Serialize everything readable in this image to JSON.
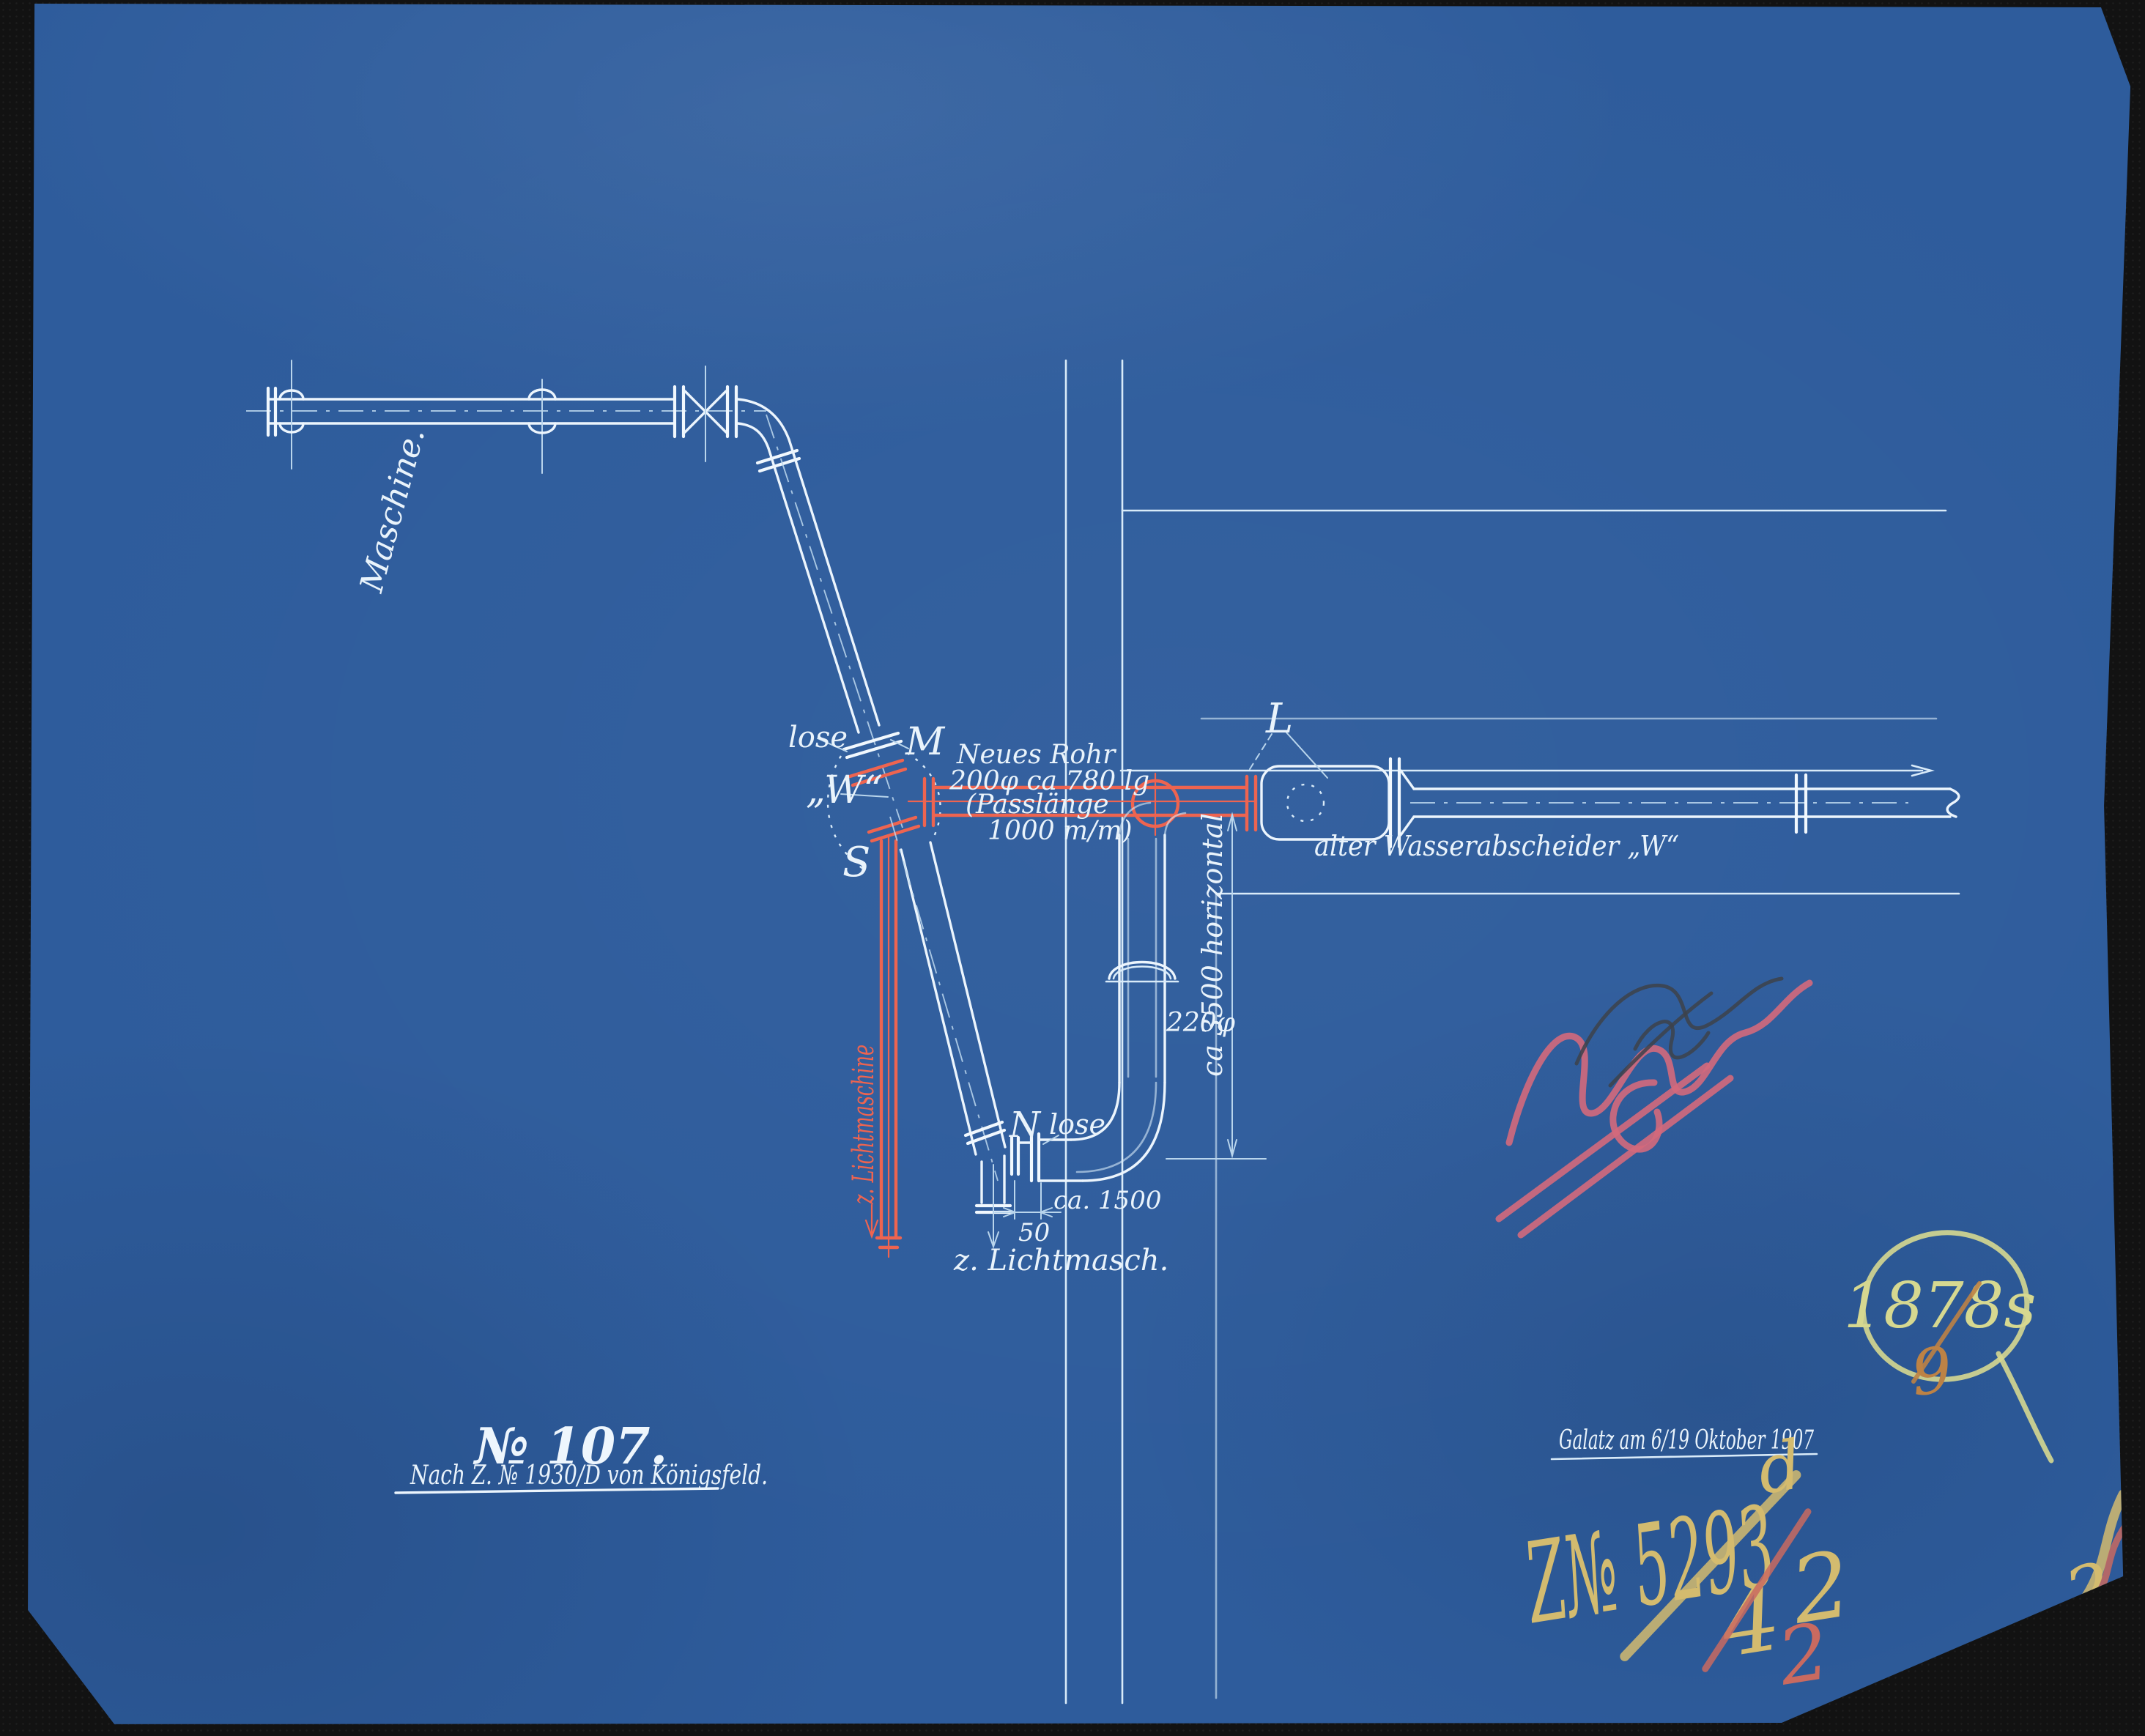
{
  "labels": {
    "machine": "Maschine.",
    "lose_top": "lose",
    "point_m": "M",
    "point_w": "„W“",
    "point_s": "S",
    "new_pipe": {
      "line1": "Neues Rohr",
      "line2": "200φ ca 780 lg",
      "line3": "(Passlänge",
      "line4": "1000 m/m)"
    },
    "point_l": "L",
    "old_separator": "alter Wasserabscheider „W“",
    "dim_3500": "ca 3500 horizontal",
    "pipe_220": "220φ",
    "point_n": "N",
    "lose_bottom": "lose",
    "dim_1500": "ca. 1500",
    "dim_50": "50",
    "to_lightmachine_short": "z. Lichtmasch.",
    "to_lightmachine_red": "z. Lichtmaschine"
  },
  "title_block": {
    "number": "№ 107.",
    "reference": "Nach Z. № 1930/D von Königsfeld."
  },
  "date_block": {
    "place_date": "Galatz am 6/19 Oktober 1907"
  },
  "stamps": {
    "inventory_circle": "1878s",
    "inventory_digit": "9",
    "registry_number": "Z№ 5293",
    "registry_sup": "d",
    "fraction_top": "4",
    "fraction_bottom": "2",
    "red_digit": "2",
    "corner_digit": "2"
  },
  "colors": {
    "paper_blue": "#2e5c9c",
    "ink_white": "#e9f3fb",
    "ink_red": "#ee6450",
    "crayon_yellow": "#d3bb6f",
    "crayon_pale_green": "#d6d890",
    "crayon_orange": "#bd8245",
    "crayon_pink": "#d4697c",
    "backdrop_black": "#121212"
  }
}
